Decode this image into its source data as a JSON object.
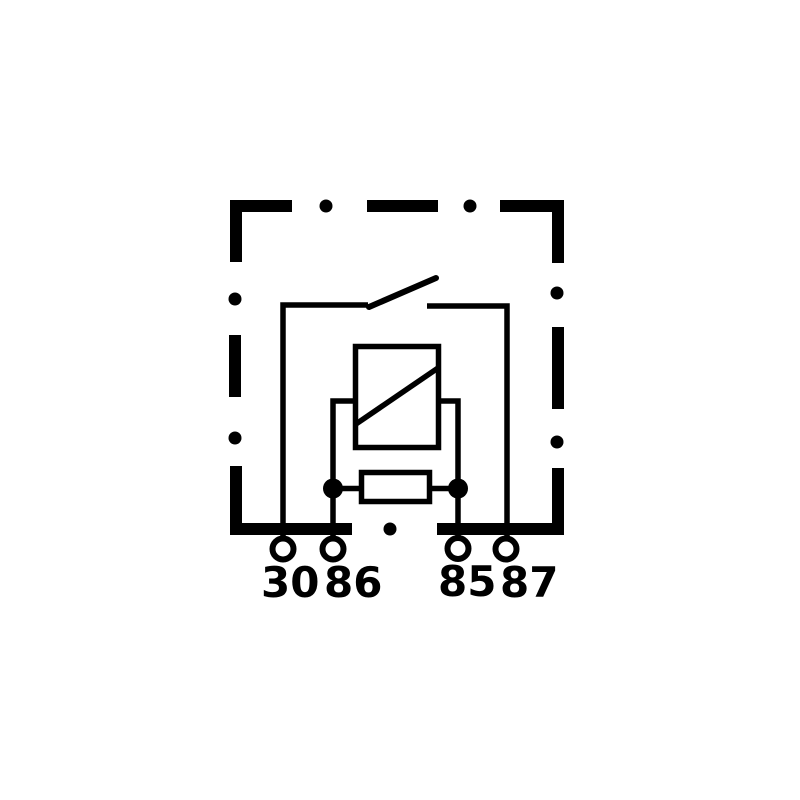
{
  "diagram": {
    "background_color": "#ffffff",
    "line_color": "#000000",
    "terminals": [
      {
        "label": "30"
      },
      {
        "label": "86"
      },
      {
        "label": "85"
      },
      {
        "label": "87"
      }
    ]
  }
}
